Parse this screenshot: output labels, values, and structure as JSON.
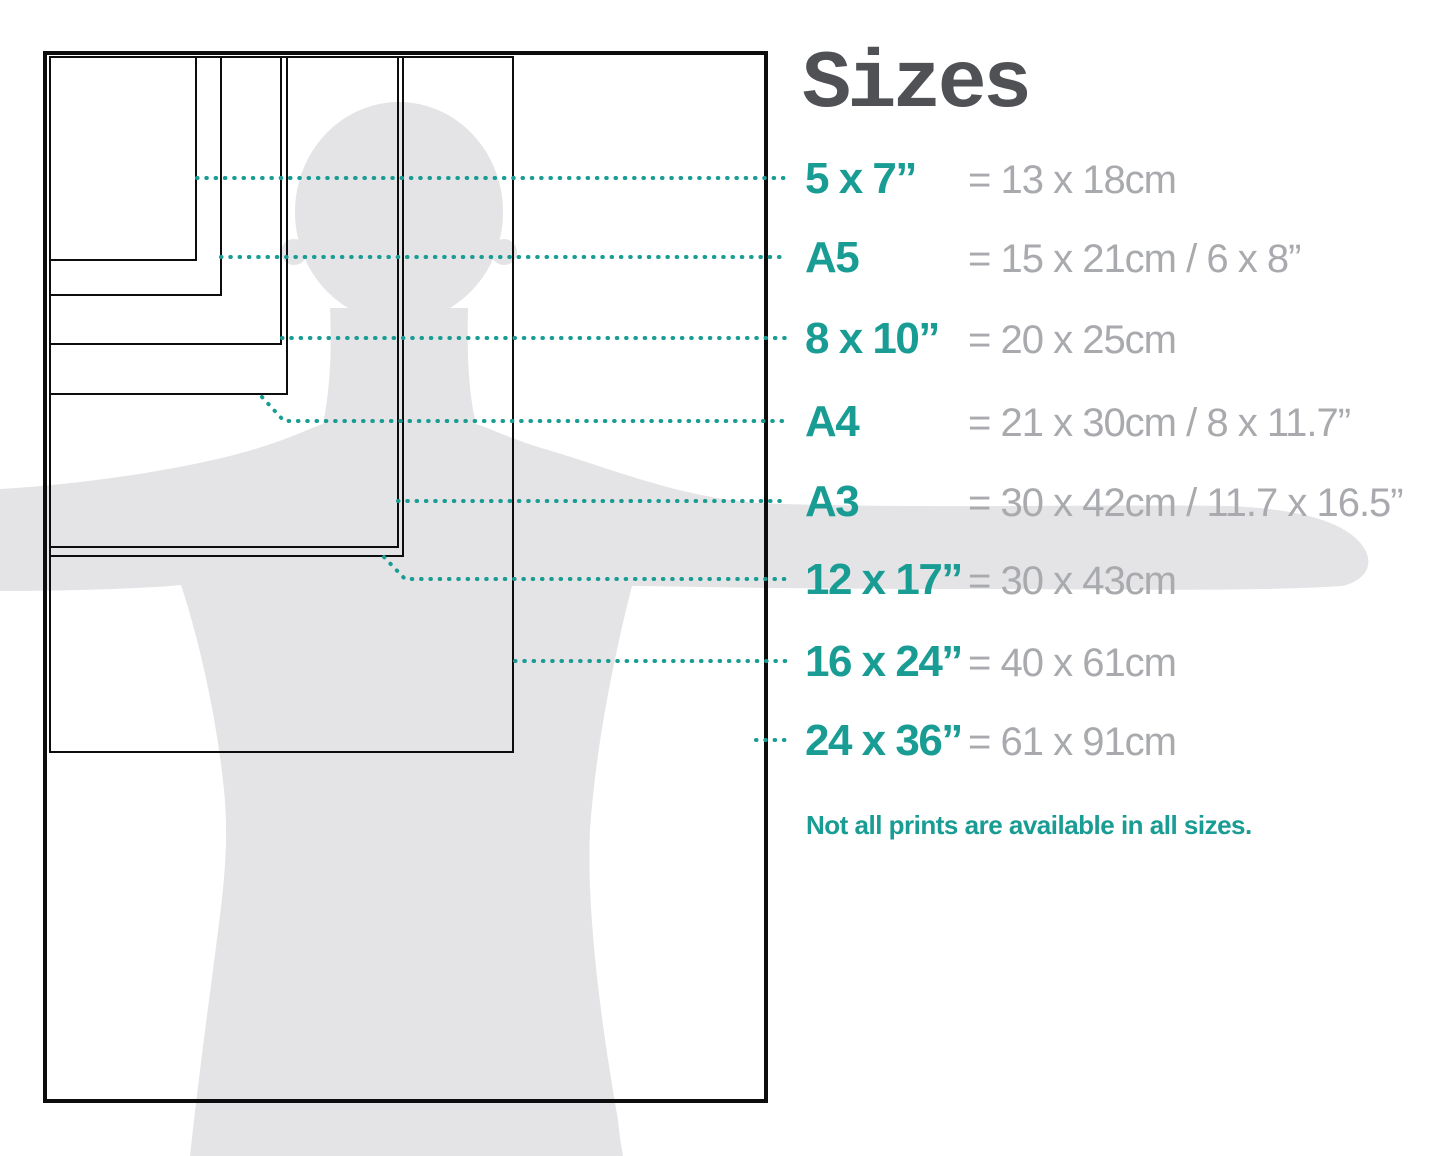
{
  "title": "Sizes",
  "note": "Not all prints are available in all sizes.",
  "colors": {
    "teal": "#189c93",
    "gray_text": "#a8aaad",
    "title_text": "#4f5155",
    "silhouette": "#e4e4e6",
    "outline": "#0d0d0d",
    "background": "#ffffff"
  },
  "diagram": {
    "description": "Nested print-size rectangles over a human silhouette with arms outstretched",
    "sizes": [
      {
        "id": "5x7",
        "label": "5 x 7”",
        "metric": "= 13 x 18cm",
        "box": {
          "x": 50,
          "y": 57,
          "w": 146,
          "h": 203
        },
        "thick": false,
        "row_y": 178,
        "leader": [
          [
            197,
            178
          ],
          [
            788,
            178
          ]
        ]
      },
      {
        "id": "a5",
        "label": "A5",
        "metric": "= 15 x 21cm / 6 x 8”",
        "box": {
          "x": 50,
          "y": 57,
          "w": 171,
          "h": 238
        },
        "thick": false,
        "row_y": 257,
        "leader": [
          [
            221,
            257
          ],
          [
            788,
            257
          ]
        ]
      },
      {
        "id": "8x10",
        "label": "8 x 10”",
        "metric": "= 20 x 25cm",
        "box": {
          "x": 50,
          "y": 57,
          "w": 231,
          "h": 287
        },
        "thick": false,
        "row_y": 338,
        "leader": [
          [
            282,
            338
          ],
          [
            788,
            338
          ]
        ]
      },
      {
        "id": "a4",
        "label": "A4",
        "metric": "= 21 x 30cm / 8 x 11.7”",
        "box": {
          "x": 50,
          "y": 57,
          "w": 237,
          "h": 337
        },
        "thick": false,
        "row_y": 421,
        "leader": [
          [
            262,
            397
          ],
          [
            284,
            421
          ],
          [
            788,
            421
          ]
        ]
      },
      {
        "id": "a3",
        "label": "A3",
        "metric": "= 30 x 42cm / 11.7 x 16.5”",
        "box": {
          "x": 50,
          "y": 57,
          "w": 348,
          "h": 490
        },
        "thick": false,
        "row_y": 501,
        "leader": [
          [
            398,
            501
          ],
          [
            788,
            501
          ]
        ]
      },
      {
        "id": "12x17",
        "label": "12 x 17”",
        "metric": "= 30 x 43cm",
        "box": {
          "x": 50,
          "y": 57,
          "w": 353,
          "h": 499
        },
        "thick": false,
        "row_y": 579,
        "leader": [
          [
            384,
            557
          ],
          [
            405,
            579
          ],
          [
            788,
            579
          ]
        ]
      },
      {
        "id": "16x24",
        "label": "16 x 24”",
        "metric": "= 40 x 61cm",
        "box": {
          "x": 50,
          "y": 57,
          "w": 463,
          "h": 695
        },
        "thick": false,
        "row_y": 661,
        "leader": [
          [
            515,
            661
          ],
          [
            788,
            661
          ]
        ]
      },
      {
        "id": "24x36",
        "label": "24 x 36”",
        "metric": "= 61 x 91cm",
        "box": {
          "x": 45,
          "y": 53,
          "w": 721,
          "h": 1048
        },
        "thick": true,
        "row_y": 740,
        "leader": [
          [
            756,
            740
          ],
          [
            788,
            740
          ]
        ]
      }
    ]
  }
}
